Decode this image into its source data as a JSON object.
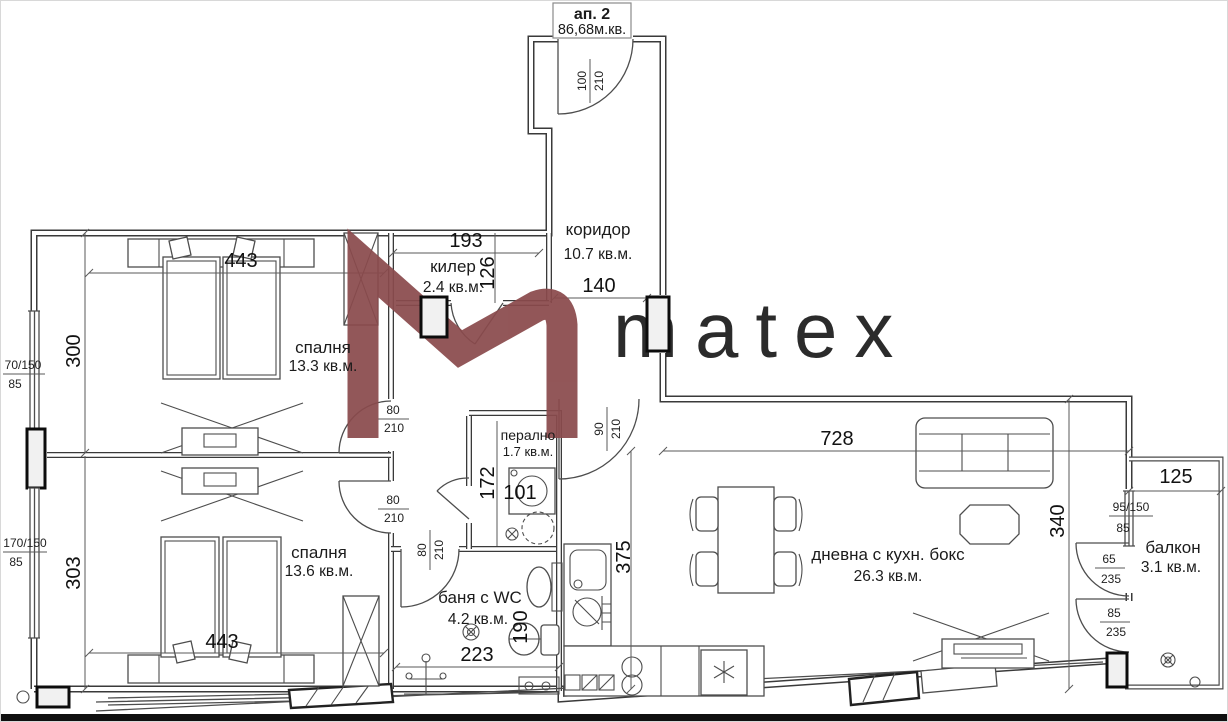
{
  "apartment": {
    "unit": "ап. 2",
    "total_area": "86,68м.кв."
  },
  "brand": {
    "logo": "matex",
    "color": "#8a4a4c"
  },
  "rooms": {
    "corridor": {
      "name": "коридор",
      "area": "10.7 кв.м."
    },
    "closet": {
      "name": "килер",
      "area": "2.4 кв.м."
    },
    "bedroom1": {
      "name": "спалня",
      "area": "13.3 кв.м."
    },
    "bedroom2": {
      "name": "спалня",
      "area": "13.6 кв.м."
    },
    "laundry": {
      "name": "перално",
      "area": "1.7 кв.м."
    },
    "bathroom": {
      "name": "баня с WC",
      "area": "4.2 кв.м."
    },
    "living": {
      "name": "дневна с кухн. бокс",
      "area": "26.3 кв.м."
    },
    "balcony": {
      "name": "балкон",
      "area": "3.1 кв.м."
    }
  },
  "dims": {
    "closet_w": "193",
    "closet_d": "126",
    "corridor_w": "140",
    "bedroom1_w": "443",
    "bedroom1_d": "300",
    "bedroom2_w": "443",
    "bedroom2_d": "303",
    "laundry_d": "172",
    "laundry_w": "101",
    "kitchen_wall": "375",
    "bath_w": "223",
    "bath_d": "190",
    "living_w": "728",
    "living_d": "340",
    "balcony_w": "125",
    "entry_door": {
      "w": "100",
      "h": "210"
    },
    "living_door": {
      "w": "90",
      "h": "210"
    },
    "inner_door": {
      "w": "80",
      "h": "210"
    },
    "win_left_top": {
      "size": "70/150",
      "sill": "85"
    },
    "win_left_bottom": {
      "size": "170/150",
      "sill": "85"
    },
    "win_balcony": {
      "size": "95/150",
      "sill": "85"
    },
    "balcony_door_left": {
      "w": "65",
      "h": "235"
    },
    "balcony_door_right": {
      "w": "85",
      "h": "235"
    }
  }
}
